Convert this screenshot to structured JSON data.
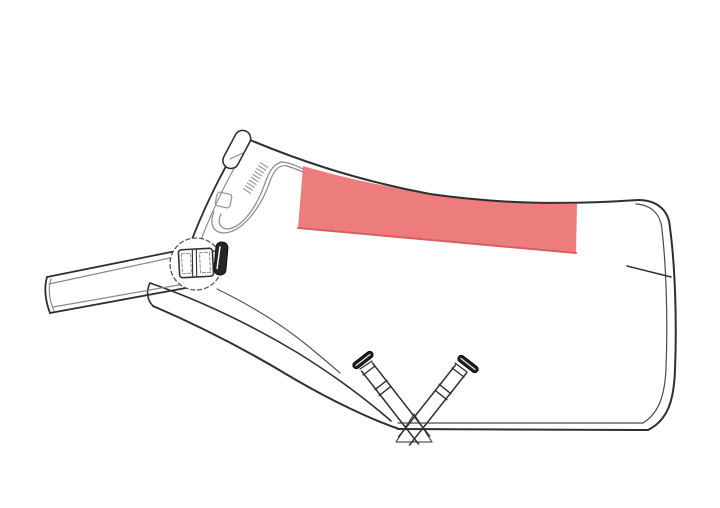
{
  "page": {
    "width": 720,
    "height": 508,
    "background": "#FFFFFF"
  },
  "colors": {
    "accent": "#ED7C7C",
    "accent_edge": "#D66060",
    "outline": "#2F2F2F",
    "seam": "#8A8A8A",
    "hardware": "#1F1F1F",
    "background": "#FFFFFF"
  },
  "diagram": {
    "kind": "horse-rug-side-view-technical-drawing",
    "viewBox": "0 0 720 508",
    "shapes": [
      {
        "name": "print-placement-area",
        "type": "path",
        "d": "M303,166 C350,180 420,194 472,199 C515,203 552,204 577,204 L576,253 L298,228 Z",
        "fill": "#ED7C7C",
        "stroke": "none",
        "interactable": true
      },
      {
        "name": "print-placement-bottom-edge",
        "type": "path",
        "d": "M576,253 L298,228",
        "stroke": "#D66060",
        "stroke_width": 2,
        "interactable": false
      },
      {
        "name": "back-top-outline",
        "type": "path",
        "d": "M243,137 C290,157 350,179 430,194 C500,204 565,205 638,200",
        "stroke": "#2F2F2F",
        "stroke_width": 2,
        "interactable": false
      },
      {
        "name": "rear-edge-outer",
        "type": "path",
        "d": "M638,200 C658,200 669,211 670,228 C675,265 677,320 675,370 C674,400 668,420 648,430",
        "stroke": "#2F2F2F",
        "stroke_width": 2,
        "interactable": false
      },
      {
        "name": "rear-edge-inner-seam",
        "type": "path",
        "d": "M636,204 C651,205 661,214 662,230 C666,264 668,318 666,368 C665,395 659,413 643,423 L398,423",
        "stroke": "#4A4A4A",
        "stroke_width": 1.2,
        "interactable": false
      },
      {
        "name": "bottom-hem-edge",
        "type": "path",
        "d": "M648,430 L398,429",
        "stroke": "#2F2F2F",
        "stroke_width": 2,
        "interactable": false
      },
      {
        "name": "tail-dart-line",
        "type": "path",
        "d": "M627,266 L671,277",
        "stroke": "#2F2F2F",
        "stroke_width": 1.5,
        "interactable": false
      },
      {
        "name": "belly-sweep-outer",
        "type": "path",
        "d": "M153,306 C195,324 243,348 291,377 C330,400 370,419 399,429",
        "stroke": "#2F2F2F",
        "stroke_width": 2,
        "interactable": false
      },
      {
        "name": "belly-sweep-upper",
        "type": "path",
        "d": "M150,283 C196,299 248,323 298,353 C335,376 367,400 391,421",
        "stroke": "#2F2F2F",
        "stroke_width": 1.6,
        "interactable": false
      },
      {
        "name": "front-flap-end-cap",
        "type": "path",
        "d": "M150,283 C146,291 147,300 153,306",
        "stroke": "#2F2F2F",
        "stroke_width": 1.6,
        "interactable": false
      },
      {
        "name": "foreleg-arch-line",
        "type": "path",
        "d": "M217,289 C250,305 281,324 308,346 C320,356 331,365 340,373",
        "stroke": "#555555",
        "stroke_width": 1.2,
        "interactable": false
      },
      {
        "name": "neckline-outer",
        "type": "path",
        "d": "M229,161 C217,182 202,213 191,242 C188,250 186,254 184,257",
        "stroke": "#2F2F2F",
        "stroke_width": 1.8,
        "interactable": false
      },
      {
        "name": "neckline-inner-seam",
        "type": "path",
        "d": "M236,165 C224,186 210,216 199,245 C196,251 194,255 192,258",
        "stroke": "#8A8A8A",
        "stroke_width": 1.2,
        "interactable": false
      },
      {
        "name": "collar-seam-outer",
        "type": "path",
        "d": "M214,212 C209,224 213,232 223,233 C243,233 261,206 269,184 C273,172 278,164 287,166 C293,168 299,170 303,172",
        "stroke": "#8A8A8A",
        "stroke_width": 1.2,
        "interactable": false
      },
      {
        "name": "collar-seam-inner",
        "type": "path",
        "d": "M221,214 C217,223 220,228 227,229 C243,228 257,205 264,186 C268,174 272,165 281,162 C288,162 297,166 303,169",
        "stroke": "#8A8A8A",
        "stroke_width": 1.2,
        "interactable": false
      },
      {
        "name": "stitched-strip-hatching",
        "type": "path",
        "d": "M243.6,188.8 L250.4,193.2 M245.5,185.9 L252.3,190.3 M247.4,183 L254.2,187.4 M249.3,180.1 L256.1,184.5 M251.2,177.2 L258,181.6 M253,174.4 L259.8,178.8 M254.9,171.5 L261.7,175.9 M256.8,168.6 L263.6,173 M258.7,165.7 L265.5,170.1 M260.6,162.8 L267.4,167.2",
        "stroke": "#9A9A9A",
        "stroke_width": 1.2,
        "interactable": false
      },
      {
        "name": "neck-loop-square",
        "type": "rect",
        "x": 216,
        "y": 193,
        "width": 15,
        "height": 14,
        "rx": 3,
        "stroke": "#9A9A9A",
        "stroke_width": 1.3,
        "transform": "rotate(12 223.5 200)",
        "interactable": false
      },
      {
        "name": "chest-strap-top-edge",
        "type": "path",
        "d": "M47,277 L186,249",
        "stroke": "#2F2F2F",
        "stroke_width": 1.8,
        "interactable": false
      },
      {
        "name": "chest-strap-top-seam",
        "type": "path",
        "d": "M49,284 L184,255",
        "stroke": "#8A8A8A",
        "stroke_width": 1.2,
        "interactable": false
      },
      {
        "name": "chest-strap-bottom-edge",
        "type": "path",
        "d": "M50,313 L186,288",
        "stroke": "#2F2F2F",
        "stroke_width": 1.8,
        "interactable": false
      },
      {
        "name": "chest-strap-bottom-seam",
        "type": "path",
        "d": "M53,307 L184,284",
        "stroke": "#8A8A8A",
        "stroke_width": 1.2,
        "interactable": false
      },
      {
        "name": "chest-strap-end-cap",
        "type": "path",
        "d": "M47,277 C44,287 45,300 50,313",
        "stroke": "#2F2F2F",
        "stroke_width": 1.8,
        "interactable": false
      },
      {
        "name": "chest-strap-end-cap-seam",
        "type": "path",
        "d": "M51,279 C48,288 49,300 54,311",
        "stroke": "#8A8A8A",
        "stroke_width": 1.2,
        "interactable": false
      },
      {
        "name": "chest-pad-disc",
        "type": "circle",
        "cx": 196,
        "cy": 264,
        "r": 26,
        "fill": "#FFFFFF",
        "stroke": "#555555",
        "stroke_width": 1.3,
        "dash": "4 3",
        "interactable": false
      },
      {
        "name": "chest-buckle-keeper",
        "type": "rect",
        "x": 210,
        "y": 251,
        "width": 7,
        "height": 16,
        "fill": "#FFFFFF",
        "stroke": "#2F2F2F",
        "stroke_width": 1.3,
        "transform": "rotate(2 213 259)",
        "interactable": true
      },
      {
        "name": "chest-buckle-body",
        "type": "rect",
        "x": 179,
        "y": 249,
        "width": 34,
        "height": 28,
        "rx": 3,
        "fill": "#FFFFFF",
        "stroke": "#2F2F2F",
        "stroke_width": 1.6,
        "transform": "rotate(-3 196 263)",
        "interactable": true
      },
      {
        "name": "chest-buckle-divider",
        "type": "path",
        "d": "M193,250 L192,276 M197,250 L196,276",
        "stroke": "#2F2F2F",
        "stroke_width": 1.1,
        "transform": "rotate(-3 196 263)",
        "interactable": false
      },
      {
        "name": "chest-buckle-stitching-right",
        "type": "rect",
        "x": 200,
        "y": 253,
        "width": 10,
        "height": 20,
        "stroke": "#8A8A8A",
        "stroke_width": 1,
        "dash": "3 2",
        "transform": "rotate(-3 196 263)",
        "interactable": false
      },
      {
        "name": "chest-buckle-stitching-left",
        "type": "rect",
        "x": 182,
        "y": 253,
        "width": 9,
        "height": 20,
        "stroke": "#8A8A8A",
        "stroke_width": 1,
        "dash": "3 2",
        "transform": "rotate(-3 196 263)",
        "interactable": false
      },
      {
        "name": "chest-closure-bar",
        "type": "rect",
        "x": 215,
        "y": 242,
        "width": 12,
        "height": 33,
        "rx": 5.5,
        "fill": "#242424",
        "stroke": "#111111",
        "stroke_width": 1,
        "transform": "rotate(5 221 258)",
        "interactable": true
      },
      {
        "name": "chest-closure-bar-highlight",
        "type": "path",
        "d": "M219,247 L218,269",
        "stroke": "#FFFFFF",
        "stroke_width": 1.4,
        "transform": "rotate(5 221 258)",
        "interactable": false
      },
      {
        "name": "withers-tab",
        "type": "rect",
        "x": 229,
        "y": 129,
        "width": 16,
        "height": 41,
        "rx": 8,
        "fill": "#FFFFFF",
        "stroke": "#2F2F2F",
        "stroke_width": 1.6,
        "transform": "rotate(28 237 149)",
        "interactable": false
      },
      {
        "name": "withers-tab-fold-line",
        "type": "path",
        "d": "M230,159 L243,153",
        "stroke": "#8A8A8A",
        "stroke_width": 1.1,
        "interactable": false
      },
      {
        "name": "surcingle-anchor-triangle",
        "type": "path",
        "d": "M396,442 L432,442 L414,414 Z",
        "stroke": "#555555",
        "stroke_width": 1.2,
        "interactable": false
      },
      {
        "name": "left-surcingle-strap",
        "type": "path",
        "d": "M361.5,371 L418.5,444 M372.5,363 L429.5,436",
        "stroke": "#2F2F2F",
        "stroke_width": 1.5,
        "interactable": true
      },
      {
        "name": "left-surcingle-tip-folds",
        "type": "path",
        "d": "M360,369 L372,361 M363,375 L375,366",
        "stroke": "#2F2F2F",
        "stroke_width": 1.3,
        "interactable": false
      },
      {
        "name": "left-surcingle-adjuster",
        "type": "path",
        "d": "M375.1,389.6 L386.9,380.4 M379.1,395.6 L390.9,386.4",
        "stroke": "#2F2F2F",
        "stroke_width": 1.4,
        "interactable": true
      },
      {
        "name": "left-surcingle-clip",
        "type": "rect",
        "x": 351,
        "y": 356.5,
        "width": 24,
        "height": 7,
        "rx": 3.5,
        "fill": "#1F1F1F",
        "stroke": "#000000",
        "stroke_width": 0.8,
        "transform": "rotate(-38 363 360)",
        "interactable": true
      },
      {
        "name": "left-surcingle-clip-highlight",
        "type": "path",
        "d": "M354,360 L372,360",
        "stroke": "#FFFFFF",
        "stroke_width": 1.1,
        "transform": "rotate(-38 363 360)",
        "interactable": false
      },
      {
        "name": "right-surcingle-strap",
        "type": "path",
        "d": "M466.5,373 L409.5,445 M455.5,365 L398.5,437",
        "stroke": "#2F2F2F",
        "stroke_width": 1.5,
        "interactable": true
      },
      {
        "name": "right-surcingle-tip-folds",
        "type": "path",
        "d": "M455,363 L467,372 M452,368 L464,377",
        "stroke": "#2F2F2F",
        "stroke_width": 1.3,
        "interactable": false
      },
      {
        "name": "right-surcingle-adjuster",
        "type": "path",
        "d": "M450.9,393.7 L439.1,384.3 M446.9,399.7 L435.1,390.3",
        "stroke": "#2F2F2F",
        "stroke_width": 1.4,
        "interactable": true
      },
      {
        "name": "right-surcingle-clip",
        "type": "rect",
        "x": 456,
        "y": 360.5,
        "width": 24,
        "height": 7,
        "rx": 3.5,
        "fill": "#1F1F1F",
        "stroke": "#000000",
        "stroke_width": 0.8,
        "transform": "rotate(38 468 364)",
        "interactable": true
      },
      {
        "name": "right-surcingle-clip-highlight",
        "type": "path",
        "d": "M459,364 L477,364",
        "stroke": "#FFFFFF",
        "stroke_width": 1.1,
        "transform": "rotate(38 468 364)",
        "interactable": false
      }
    ]
  }
}
